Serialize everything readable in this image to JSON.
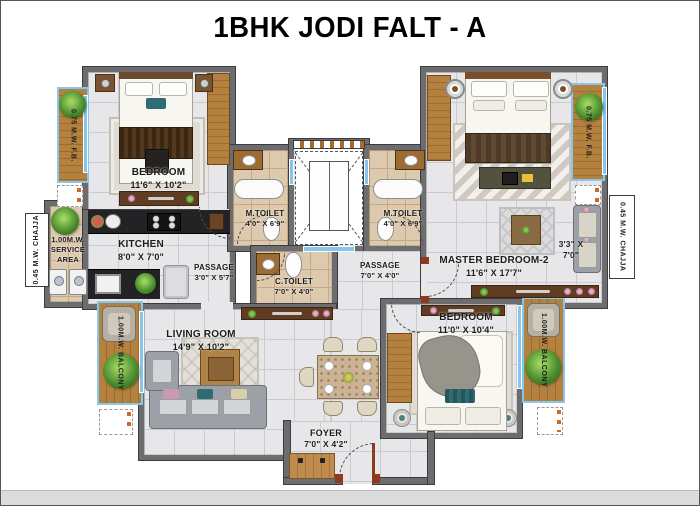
{
  "title": "1BHK JODI FALT - A",
  "rooms": {
    "bedroom_left": {
      "name": "BEDROOM",
      "dims": "11'6\" X 10'2\""
    },
    "kitchen": {
      "name": "KITCHEN",
      "dims": "8'0\" X 7'0\""
    },
    "passage_left": {
      "name": "PASSAGE",
      "dims": "3'0\" X 5'7\""
    },
    "m_toilet": {
      "name": "M.TOILET",
      "dims": "4'0\" X 6'9\""
    },
    "c_toilet": {
      "name": "C.TOILET",
      "dims": "7'0\" X 4'0\""
    },
    "passage_right": {
      "name": "PASSAGE",
      "dims": "7'0\" X 4'0\""
    },
    "living_room": {
      "name": "LIVING ROOM",
      "dims": "14'9\" X 10'2\""
    },
    "foyer": {
      "name": "FOYER",
      "dims": "7'0\" X 4'2\""
    },
    "master_bedroom_2": {
      "name": "MASTER BEDROOM-2",
      "dims": "11'6\" X 17'7\""
    },
    "sitout_nook": {
      "dims_line1": "3'3\" X",
      "dims_line2": "7'0\""
    },
    "bedroom_right": {
      "name": "BEDROOM",
      "dims": "11'0\" X 10'4\""
    }
  },
  "exterior": {
    "flower_bed_left": "0.75 M.W. F.B.",
    "flower_bed_right": "0.75 M.W. F.B.",
    "chajja_left": "0.45 M.W. CHAJJA",
    "chajja_right": "0.45 M.W. CHAJJA",
    "service_area": "1.00M.W. SERVICE AREA",
    "balcony_left": "1.00M.W. BALCONY",
    "balcony_right": "1.00M.W. BALCONY"
  },
  "colors": {
    "wall": "#6d6d70",
    "wall_outline": "#3c3c3e",
    "floor_tile": "#e7e7e9",
    "grout": "#cbcbcf",
    "toilet_floor": "#ddc9ad",
    "toilet_grout": "#c2a988",
    "wood": "#b5813f",
    "wood_dark": "#9c6c30",
    "glass": "#85c6ec",
    "door_frame": "#8c3a20",
    "counter_dark": "#232325",
    "sofa_gray": "#9da0a7",
    "plant_green": "#4e8f31",
    "console": "#5f3c22",
    "title_text": "#000000",
    "label_text": "#1c1c1c"
  }
}
